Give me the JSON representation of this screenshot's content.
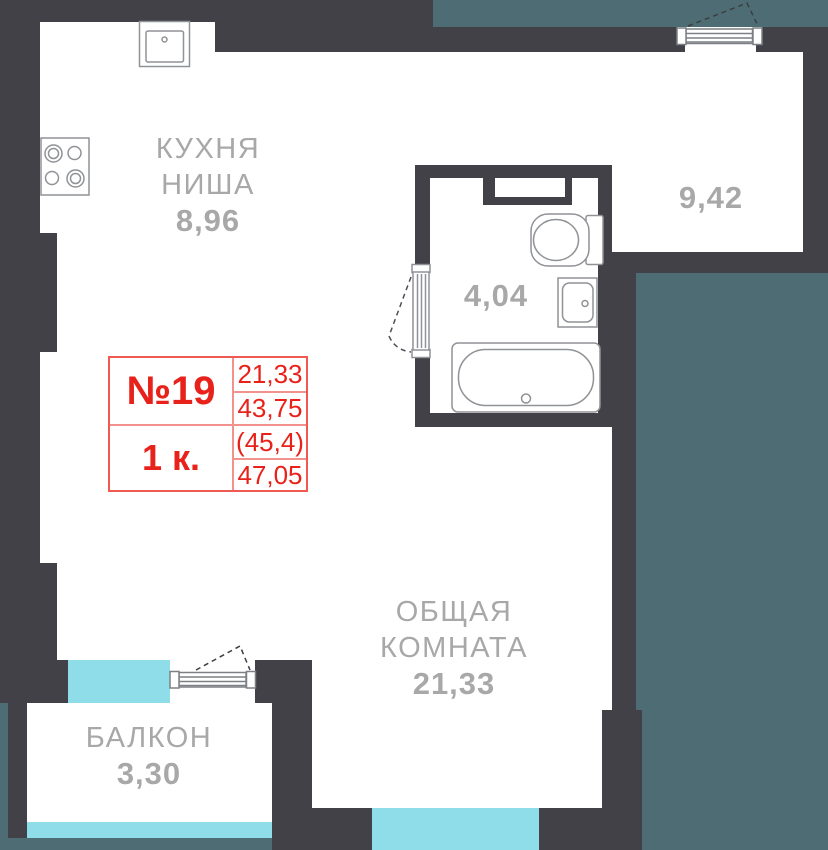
{
  "card": {
    "number": "№19",
    "rooms_type": "1 к.",
    "areas": [
      "21,33",
      "43,75",
      "(45,4)",
      "47,05"
    ]
  },
  "rooms": {
    "kitchen": {
      "name_line1": "КУХНЯ",
      "name_line2": "НИША",
      "area": "8,96"
    },
    "bathroom": {
      "area": "4,04"
    },
    "room_top_right": {
      "area": "9,42"
    },
    "living": {
      "name_line1": "ОБЩАЯ",
      "name_line2": "КОМНАТА",
      "area": "21,33"
    },
    "balcony": {
      "name": "БАЛКОН",
      "area": "3,30"
    }
  },
  "colors": {
    "wall": "#414147",
    "adjacent_area_teal": "#4d6c74",
    "window_cyan": "#8edde9",
    "label_gray": "#a8a8a8",
    "card_red": "#e8211a"
  }
}
